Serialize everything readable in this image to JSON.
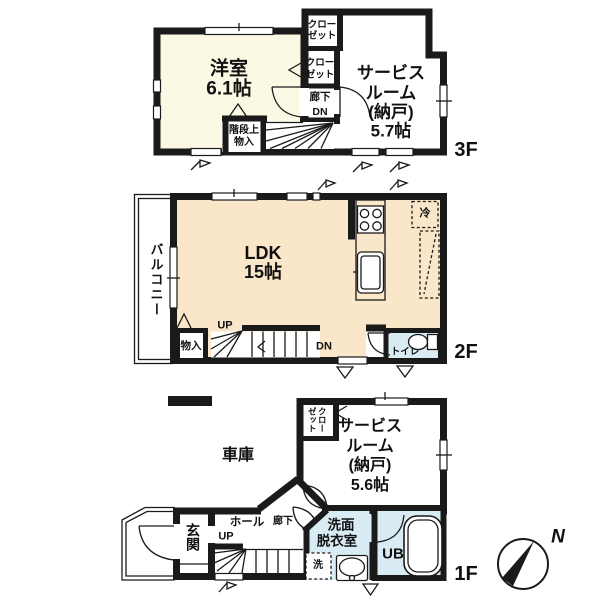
{
  "colors": {
    "wall": "#1a1a1a",
    "cream": "#fbf8e4",
    "peach": "#fae6c8",
    "blue": "#d9ecf4"
  },
  "floor3": {
    "label": "3F",
    "western_room": {
      "name": "洋室",
      "size": "6.1帖"
    },
    "closet_top": {
      "line1": "クロー",
      "line2": "ゼット"
    },
    "closet_mid": {
      "line1": "クロー",
      "line2": "ゼット"
    },
    "corridor": "廊下",
    "down": "DN",
    "stair_storage": {
      "line1": "階段上",
      "line2": "物入"
    },
    "service_room": {
      "line1": "サービス",
      "line2": "ルーム",
      "line3": "(納戸)",
      "line4": "5.7帖"
    }
  },
  "floor2": {
    "label": "2F",
    "balcony": "バルコニー",
    "ldk": {
      "name": "LDK",
      "size": "15帖"
    },
    "storage": "物入",
    "up": "UP",
    "down": "DN",
    "refrigerator": "冷",
    "toilet": "トイレ"
  },
  "floor1": {
    "label": "1F",
    "garage": "車庫",
    "closet": {
      "col_right": "クロー",
      "col_left": "ゼット"
    },
    "service_room": {
      "line1": "サービス",
      "line2": "ルーム",
      "line3": "(納戸)",
      "line4": "5.6帖"
    },
    "entrance": "玄関",
    "hall": "ホール",
    "up": "UP",
    "corridor": "廊下",
    "washroom": {
      "line1": "洗面",
      "line2": "脱衣室"
    },
    "laundry": "洗",
    "unit_bath": "UB"
  },
  "compass": {
    "north": "N"
  }
}
